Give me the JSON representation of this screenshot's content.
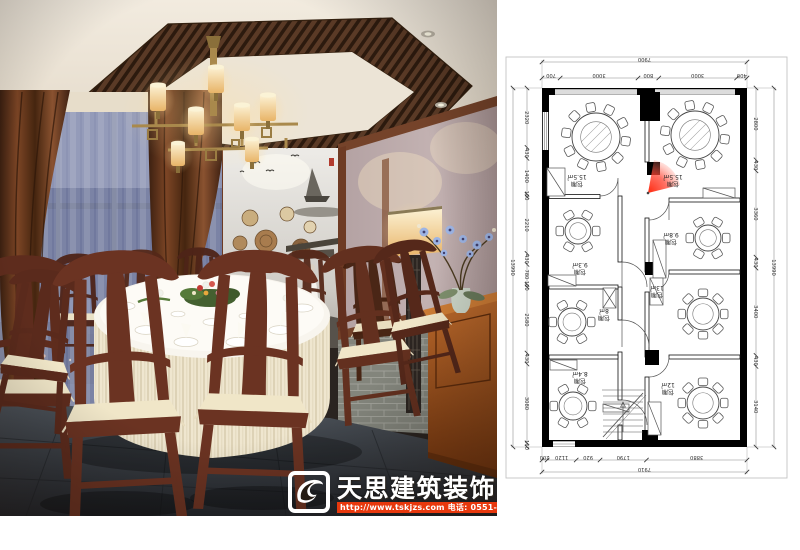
{
  "watermark": {
    "brand": "天思建筑装饰",
    "contact": "http://www.tskjzs.com 电话: 0551-65568226",
    "bar_color": "#e8380d"
  },
  "photo": {
    "description": "Chinese restaurant private dining room rendering",
    "palette": {
      "wood": "#6b3322",
      "cushion": "#f0e6c8",
      "ceiling": "#efe8dc",
      "night_window": "#222e52",
      "drape": "#6e3c1f",
      "floor": "#3a3f45",
      "sideboard": "#a85a24"
    }
  },
  "floorplan": {
    "camera_cone_color": "#ee2200",
    "rooms": [
      {
        "name": "包厢",
        "area": "15.5㎡",
        "cx": 99,
        "cy": 137,
        "table_r": 24,
        "seats": 10,
        "label_x": 80,
        "label_y": 180
      },
      {
        "name": "包厢",
        "area": "15.5㎡",
        "cx": 198,
        "cy": 135,
        "table_r": 24,
        "seats": 10,
        "label_x": 176,
        "label_y": 180
      },
      {
        "name": "包厢",
        "area": "9.3㎡",
        "cx": 81,
        "cy": 231,
        "table_r": 13,
        "seats": 6,
        "label_x": 83,
        "label_y": 268
      },
      {
        "name": "包厢",
        "area": "9.8㎡",
        "cx": 211,
        "cy": 238,
        "table_r": 13,
        "seats": 6,
        "label_x": 174,
        "label_y": 238
      },
      {
        "name": "包厢",
        "area": "8㎡",
        "cx": 75,
        "cy": 322,
        "table_r": 14,
        "seats": 6,
        "label_x": 107,
        "label_y": 314
      },
      {
        "name": "包厢",
        "area": "13㎡",
        "cx": 206,
        "cy": 314,
        "table_r": 16,
        "seats": 8,
        "label_x": 160,
        "label_y": 291
      },
      {
        "name": "包厢",
        "area": "8.4㎡",
        "cx": 76,
        "cy": 406,
        "table_r": 14,
        "seats": 6,
        "label_x": 83,
        "label_y": 377
      },
      {
        "name": "包厢",
        "area": "12㎡",
        "cx": 206,
        "cy": 403,
        "table_r": 16,
        "seats": 8,
        "label_x": 171,
        "label_y": 388
      }
    ],
    "dims": {
      "top_total": "7900",
      "top_chain": [
        "700",
        "3000",
        "800",
        "3000",
        "400"
      ],
      "bottom_chain": [
        "200",
        "1120",
        "920",
        "1790",
        "3880"
      ],
      "bottom_total": "7910",
      "left_total": "13990",
      "left_chain": [
        "2320",
        "430",
        "1400",
        "100",
        "2210",
        "430",
        "780",
        "100",
        "2580",
        "430",
        "3080",
        "160"
      ],
      "right_total": "13990",
      "right_chain": [
        "2800",
        "430",
        "3360",
        "430",
        "3400",
        "430",
        "3140"
      ]
    }
  }
}
